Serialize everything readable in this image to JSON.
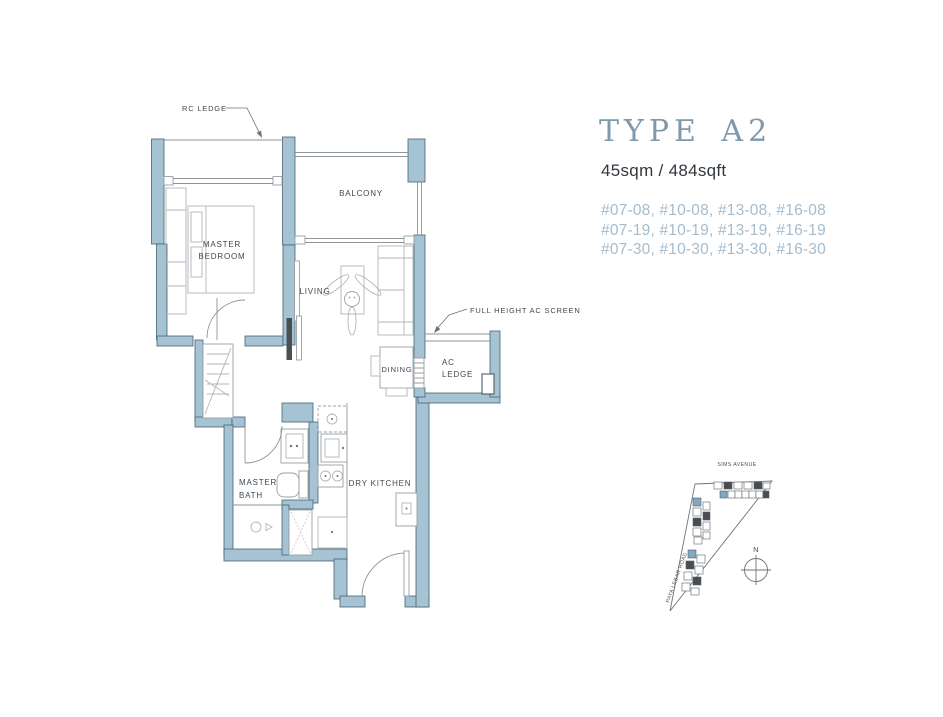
{
  "unit": {
    "type": "TYPE A2",
    "area": "45sqm / 484sqft",
    "stacks": [
      "#07-08, #10-08, #13-08, #16-08",
      "#07-19, #10-19, #13-19, #16-19",
      "#07-30, #10-30, #13-30, #16-30"
    ]
  },
  "plan": {
    "callouts": {
      "rc_ledge": "RC LEDGE",
      "full_height_ac_screen": "FULL HEIGHT AC SCREEN"
    },
    "rooms": {
      "master_bedroom": [
        "MASTER",
        "BEDROOM"
      ],
      "balcony": "BALCONY",
      "living": "LIVING",
      "dining": "DINING",
      "ac_ledge": [
        "AC",
        "LEDGE"
      ],
      "master_bath": [
        "MASTER",
        "BATH"
      ],
      "dry_kitchen": "DRY KITCHEN"
    }
  },
  "site_map": {
    "street_top": "SIMS AVENUE",
    "street_left": "PAYA LEBAR ROAD",
    "north_label": "N"
  },
  "colors": {
    "wall_fill": "#a6c3d4",
    "wall_stroke": "#44626f",
    "title_text": "#7e99ac",
    "stack_text": "#a4bccd",
    "label_text": "#41484e"
  }
}
